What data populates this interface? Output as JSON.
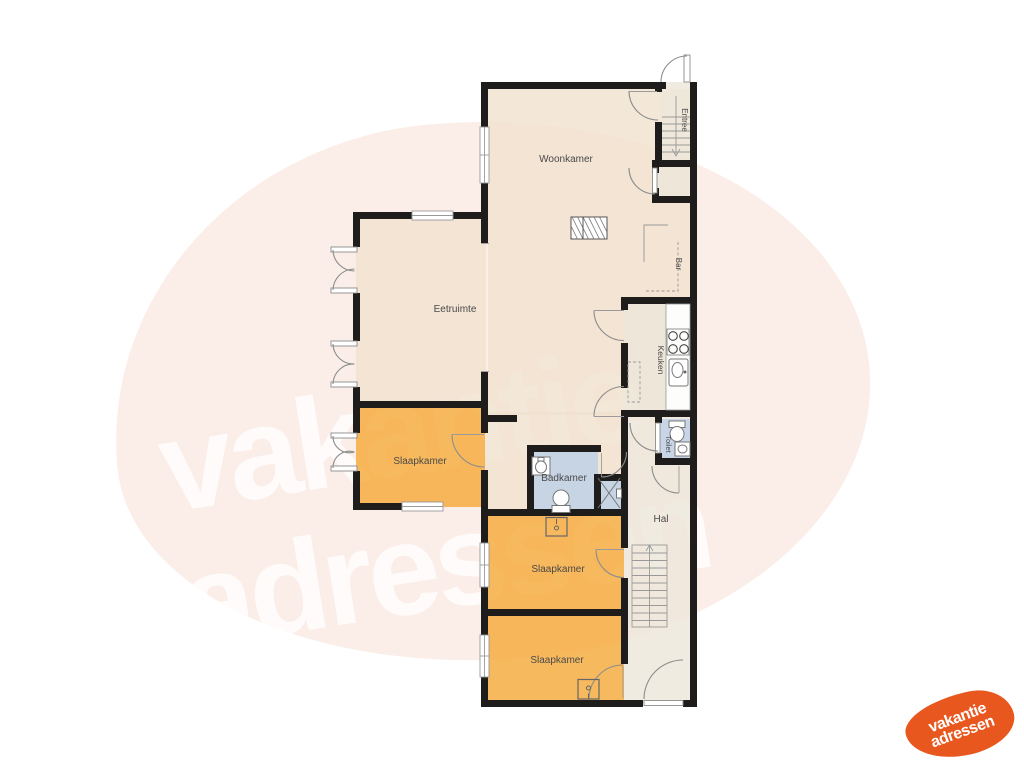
{
  "floorplan": {
    "rooms": {
      "woonkamer": "Woonkamer",
      "eetruimte": "Eetruimte",
      "slaapkamer_left": "Slaapkamer",
      "slaapkamer_middle": "Slaapkamer",
      "slaapkamer_bottom": "Slaapkamer",
      "keuken": "Keuken",
      "badkamer": "Badkamer",
      "toilet": "Toilet",
      "hal": "Hal",
      "entree": "Entree",
      "bar": "Bar"
    }
  },
  "watermark": {
    "line1": "vakantie",
    "line2": "adressen"
  },
  "logo": {
    "line1": "vakantie",
    "line2": "adressen"
  },
  "colors": {
    "wall": "#1e1d1b",
    "room_cream": "#f0e2cf",
    "room_light": "#ede6da",
    "room_orange": "#f5a93a",
    "room_blue": "#bdd1e8",
    "blob": "#fbeee8",
    "watermark_text": "#ffffff",
    "logo_orange": "#e8571e",
    "label_text": "#4a4a4a",
    "line_gray": "#8c8c8c"
  }
}
